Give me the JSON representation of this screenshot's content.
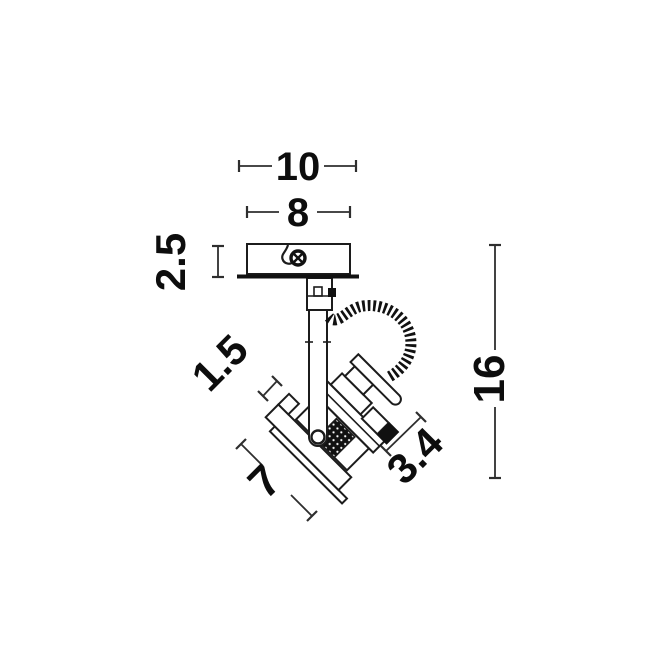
{
  "page": {
    "background_color": "#ffffff",
    "line_color": "#1c1c1c",
    "dimension_line_color": "#2e2e2e",
    "text_color": "#0d0d0d",
    "description": "Technical dimension line drawing of an adjustable ceiling spot light fixture"
  },
  "drawing": {
    "dimensions": {
      "overall_width": {
        "value": "10"
      },
      "base_width": {
        "value": "8"
      },
      "base_height": {
        "value": "2.5"
      },
      "arm_thickness": {
        "value": "1.5"
      },
      "overall_height": {
        "value": "16"
      },
      "head_length": {
        "value": "7"
      },
      "head_depth": {
        "value": "3.4"
      }
    }
  }
}
